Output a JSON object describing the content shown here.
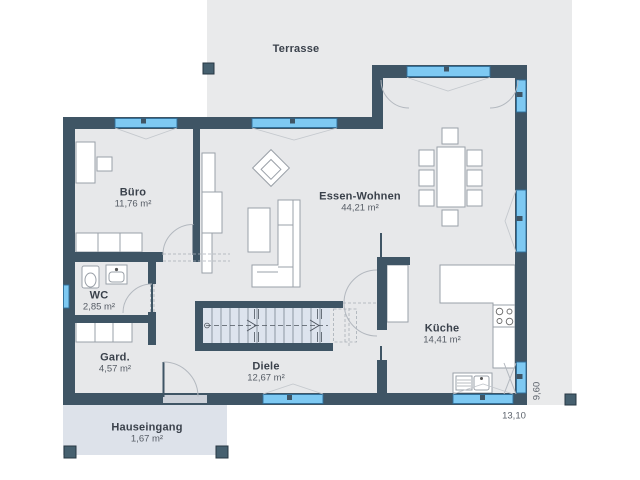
{
  "plan": {
    "rooms": [
      {
        "name": "Terrasse",
        "area": ""
      },
      {
        "name": "Büro",
        "area": "11,76 m²"
      },
      {
        "name": "Essen-Wohnen",
        "area": "44,21 m²"
      },
      {
        "name": "WC",
        "area": "2,85 m²"
      },
      {
        "name": "Gard.",
        "area": "4,57 m²"
      },
      {
        "name": "Diele",
        "area": "12,67 m²"
      },
      {
        "name": "Küche",
        "area": "14,41 m²"
      },
      {
        "name": "Hauseingang",
        "area": "1,67 m²"
      }
    ],
    "dimensions": {
      "width": "13,10",
      "depth": "9,60"
    },
    "colors": {
      "wall": "#3f5565",
      "window_fill": "#7ec9f2",
      "window_border": "#2f6f9b",
      "room_floor": "#e7e8ea",
      "terrace": "#e9eaeb",
      "porch": "#dde2ea",
      "stairs": "#dde4ee",
      "text": "#3a414b"
    }
  }
}
